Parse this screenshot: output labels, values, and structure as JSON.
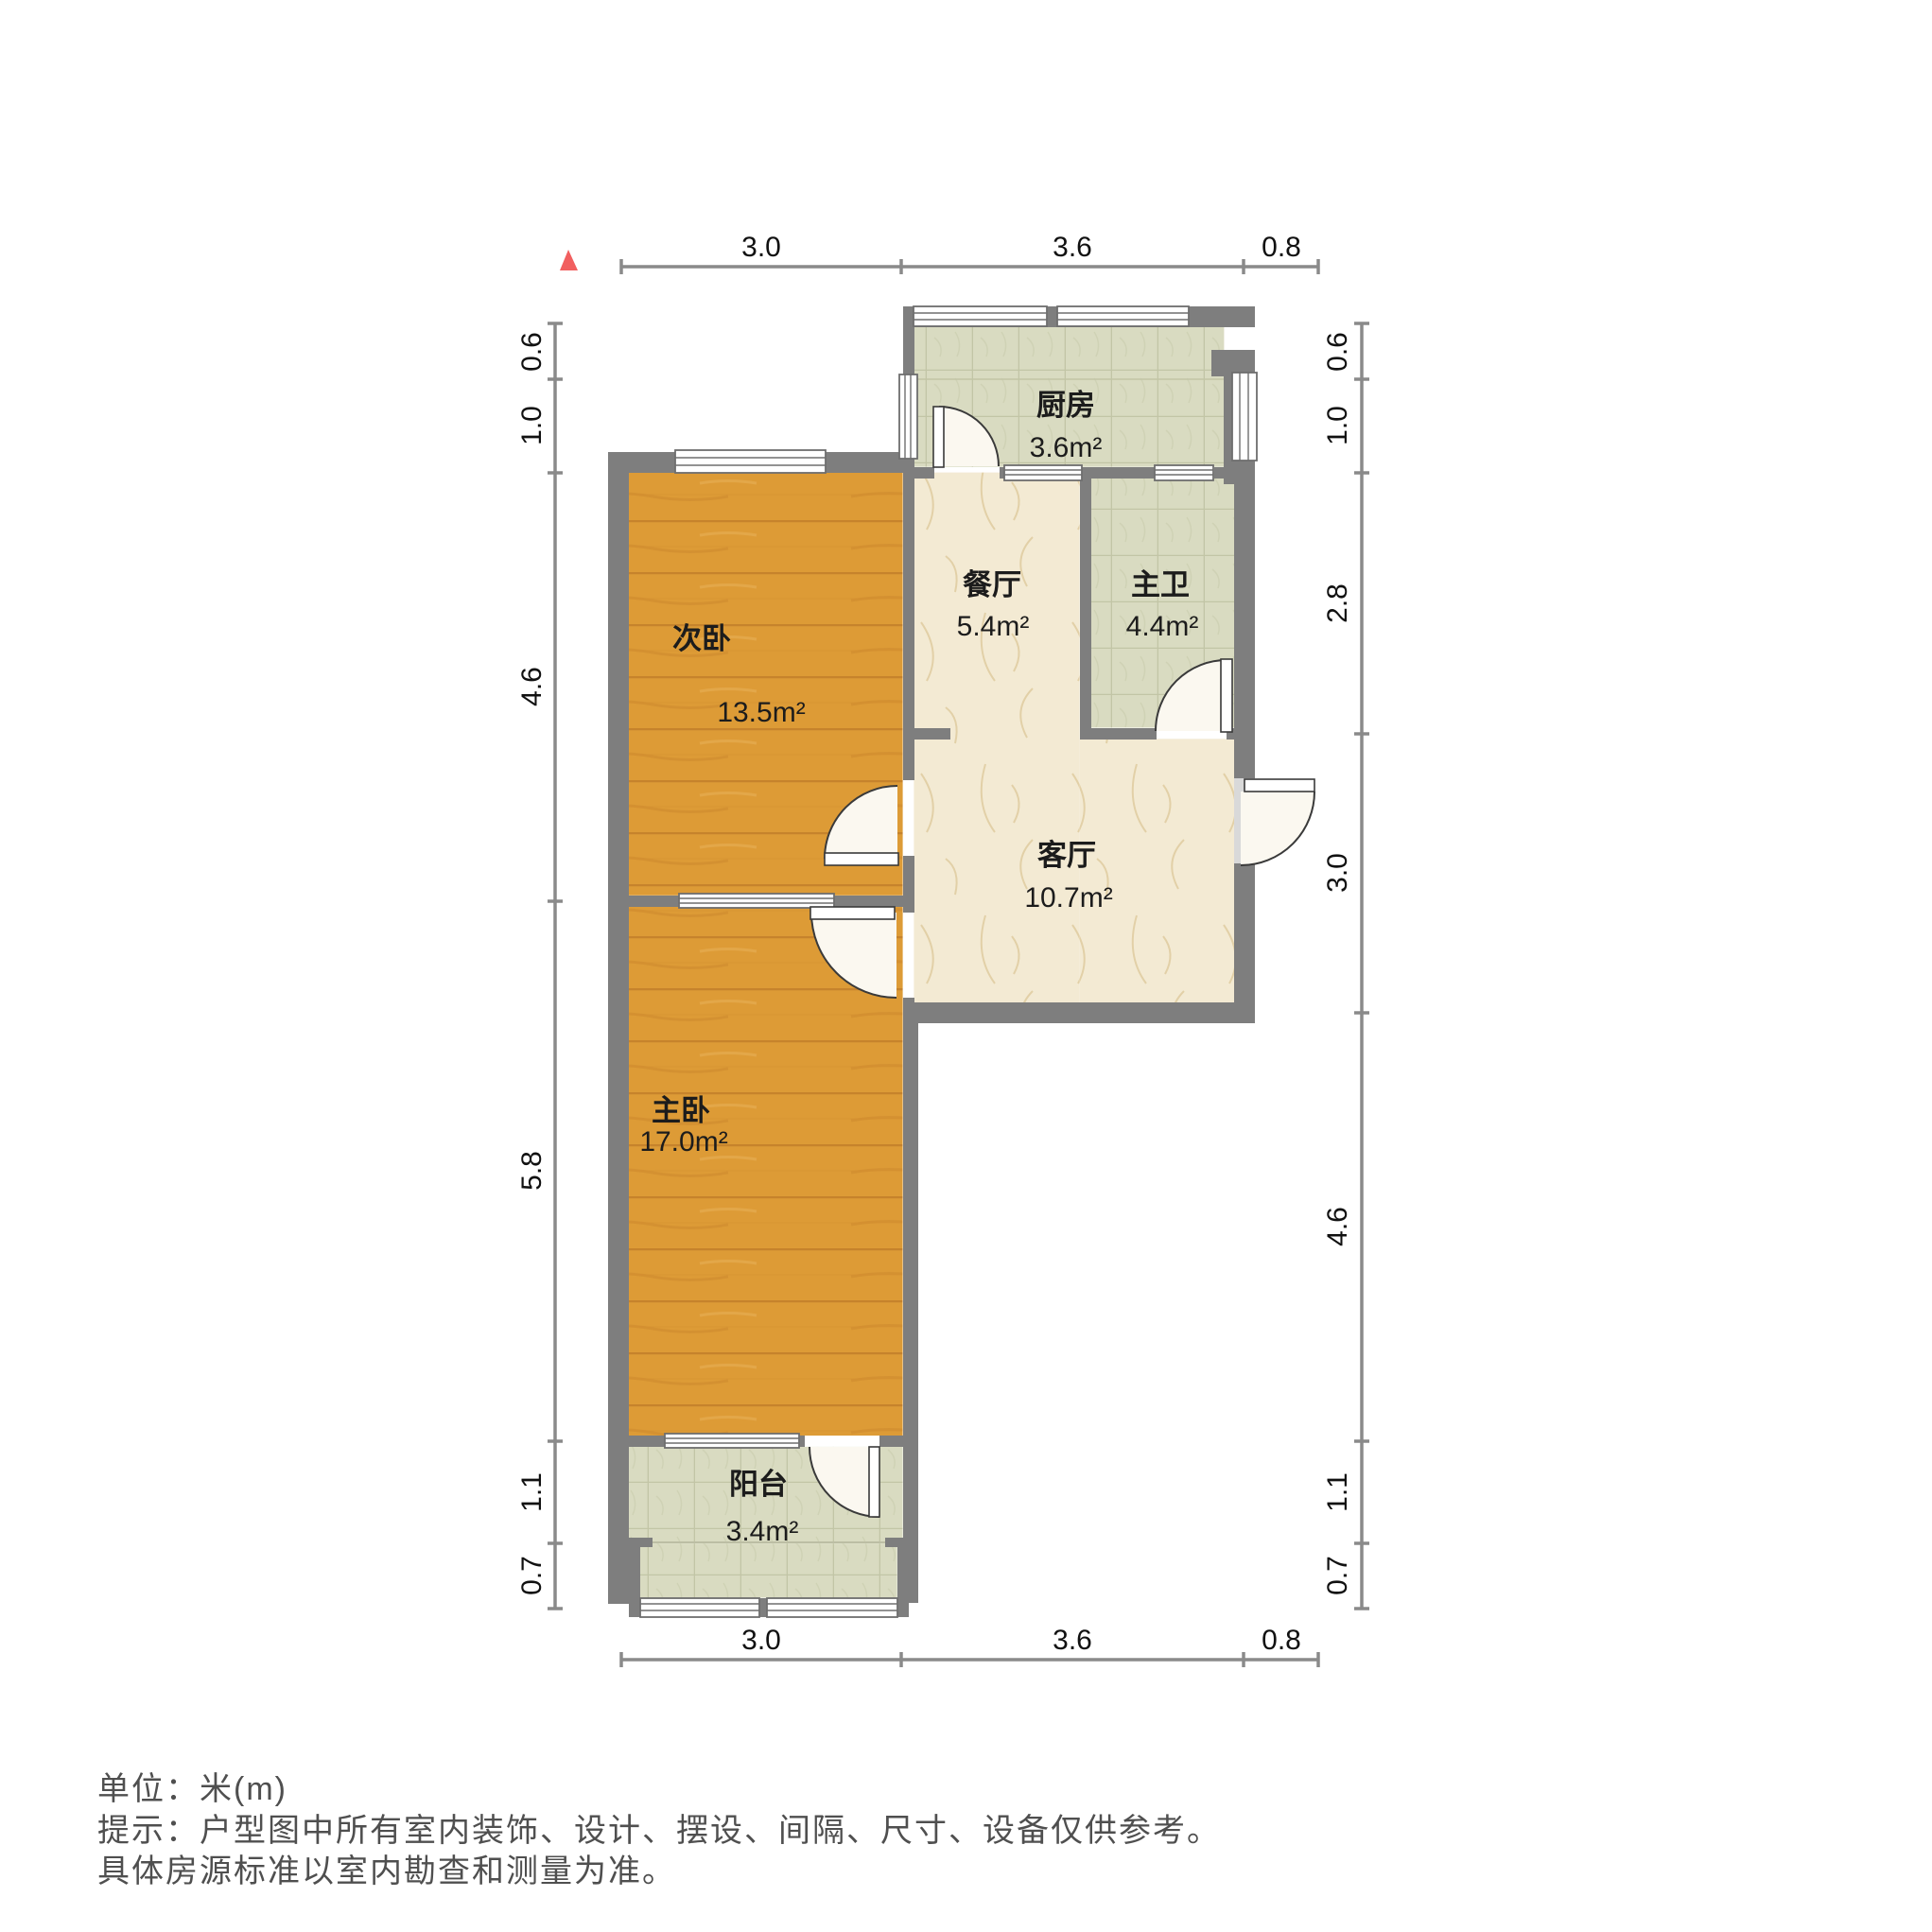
{
  "floorplan": {
    "north_indicator": "north-triangle",
    "rooms": {
      "kitchen": {
        "name": "厨房",
        "area": "3.6m²"
      },
      "dining": {
        "name": "餐厅",
        "area": "5.4m²"
      },
      "master_bath": {
        "name": "主卫",
        "area": "4.4m²"
      },
      "second_bedroom": {
        "name": "次卧",
        "area": "13.5m²"
      },
      "living": {
        "name": "客厅",
        "area": "10.7m²"
      },
      "master_bedroom": {
        "name": "主卧",
        "area": "17.0m²"
      },
      "balcony": {
        "name": "阳台",
        "area": "3.4m²"
      }
    },
    "dimensions": {
      "top": [
        "3.0",
        "3.6",
        "0.8"
      ],
      "bottom": [
        "3.0",
        "3.6",
        "0.8"
      ],
      "left": [
        "0.6",
        "1.0",
        "4.6",
        "5.8",
        "1.1",
        "0.7"
      ],
      "right": [
        "0.6",
        "1.0",
        "2.8",
        "3.0",
        "4.6",
        "1.1",
        "0.7"
      ]
    },
    "footer": {
      "unit": "单位：米(m)",
      "tip1": "提示：户型图中所有室内装饰、设计、摆设、间隔、尺寸、设备仅供参考。",
      "tip2": "具体房源标准以室内勘查和测量为准。"
    },
    "colors": {
      "wall": "#7e7e7e",
      "wood": "#dd9b36",
      "marble": "#f3ead3",
      "tile": "#d9dbc1",
      "north": "#f15f5f"
    }
  }
}
